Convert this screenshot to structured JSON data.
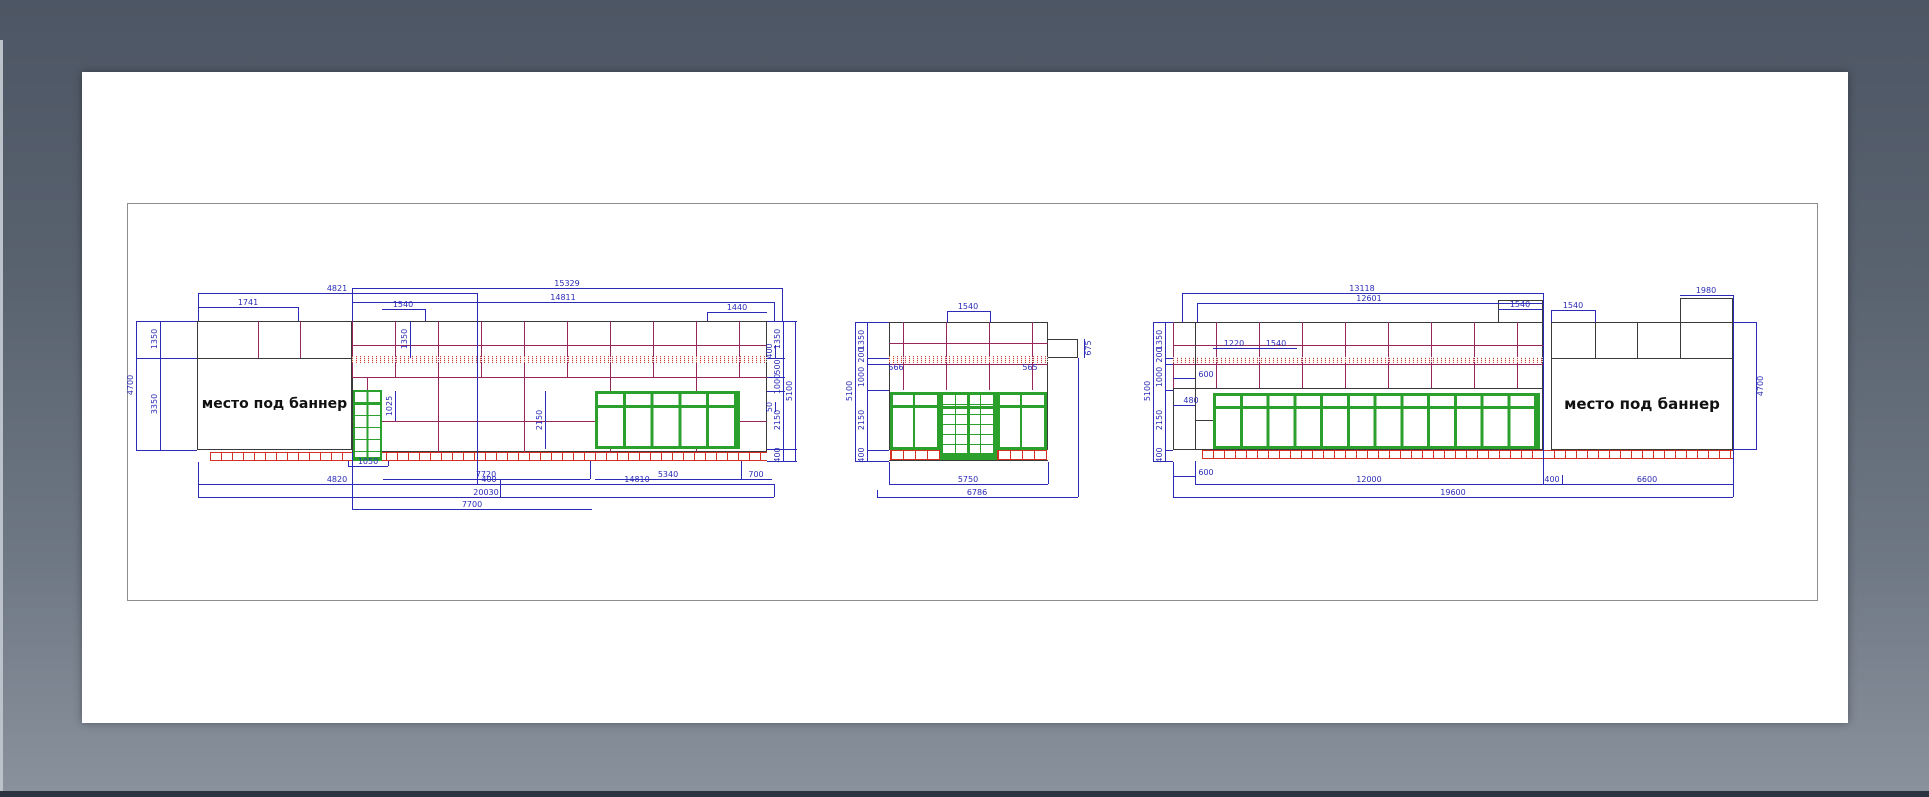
{
  "banner": {
    "left": "место под баннер",
    "right": "место под баннер"
  },
  "d": {
    "left": {
      "top": [
        "4821",
        "1741",
        "15329",
        "14811",
        "1540",
        "1440"
      ],
      "side_left": [
        "1350",
        "3350",
        "4700"
      ],
      "inner": [
        "1350",
        "1025",
        "2150"
      ],
      "right_inner": [
        "400",
        "50"
      ],
      "right_chain": [
        "1350",
        "500",
        "1000",
        "2150",
        "400"
      ],
      "right_overall": "5100",
      "bottom": [
        "1050",
        "7720",
        "5340",
        "700",
        "4820",
        "400",
        "14810",
        "20030",
        "7700"
      ]
    },
    "middle": {
      "top": [
        "1540"
      ],
      "chain": [
        "1350",
        "200",
        "1000",
        "2150",
        "400"
      ],
      "overall": "5100",
      "inner": [
        "566",
        "565",
        "675"
      ],
      "bottom": [
        "5750",
        "6786"
      ]
    },
    "right": {
      "top": [
        "13118",
        "12601",
        "1540",
        "1540",
        "1980"
      ],
      "chain": [
        "1350",
        "200",
        "1000",
        "2150",
        "400"
      ],
      "overall": "5100",
      "inner": [
        "1220",
        "1540",
        "600",
        "480"
      ],
      "side_right": "4700",
      "bottom": [
        "600",
        "12000",
        "400",
        "6600",
        "19600"
      ]
    }
  },
  "colors": {
    "background_top": "#4d5664",
    "background_bottom": "#8a929d",
    "paper": "#ffffff",
    "dimension_blue": "#2b2bb8",
    "grid_maroon": "#96275a",
    "outline_dark": "#3a3a3a",
    "storefront_green": "#2ca02c",
    "brick_red": "#d43024"
  }
}
